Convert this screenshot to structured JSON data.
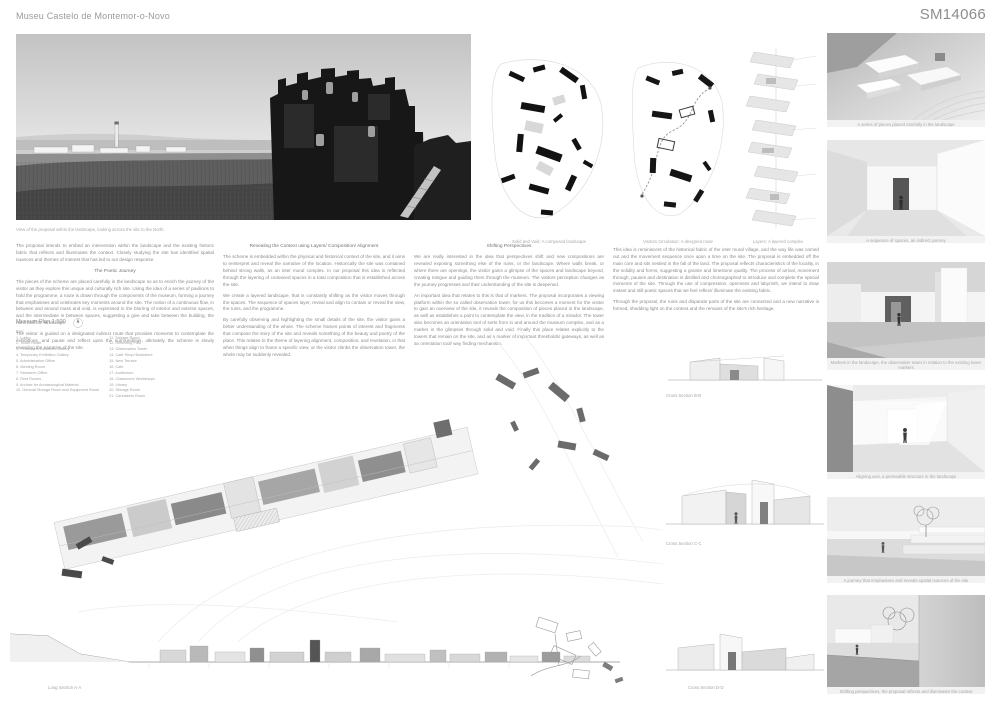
{
  "colors": {
    "paper": "#ffffff",
    "ink": "#1a1a1a",
    "muted_text": "#8b8b8b",
    "caption_gray": "#a8a8a8"
  },
  "header": {
    "title": "Museu Castelo de Montemor-o-Novo",
    "code": "SM14066"
  },
  "photo": {
    "caption": "View of the proposal within the landscape, looking across the site to the North."
  },
  "diagrams": [
    {
      "caption": "Solid and Void: A composed landscape"
    },
    {
      "caption": "Visitors Circulation: A designed route"
    },
    {
      "caption": "Layers: A layered complex"
    }
  ],
  "essays": {
    "col_a": {
      "intro": "The proposal intends to embed an intervention within the landscape and the existing historic fabric that reflects and illuminates the context. Closely studying the site has identified spatial nuances and themes of interest that has led to our design response.",
      "heading": "The Poetic Journey",
      "p1": "The pieces of the scheme are placed carefully in the landscape so as to enrich the journey of the visitor as they explore this unique and culturally rich site. Using the idea of a series of pavilions to hold the programme, a route is drawn through the components of the museum, forming a journey that emphasises and celebrates key moments around the site. The notion of a continuous flow, in between and around mass and void, is expressed in the blurring of interior and exterior spaces, and the intermediate in between spaces, suggesting a give and take between the building, the ruins and the landscape.",
      "p2": "The visitor is guided on a designated indirect route that provides moments to contemplate the exhibitions, and pause and reflect upon the surroundings, ultimately the scheme is slowly revealing the narrative of the site."
    },
    "col_b": {
      "heading": "Revealing the Context using Layers/ Composition/ Alignment",
      "p1": "The scheme is embedded within the physical and historical context of the site, and it aims to reinterpret and reveal the narrative of the location. Historically the site was contained behind strong walls, as an inter mural complex. In our proposal this idea is reflected through the layering of contained spaces in a total composition that is established across the site.",
      "p2": "We create a layered landscape, that is constantly shifting as the visitor moves through the spaces. The sequence of spaces layer, reveal and align to contain or reveal the view, the ruins, and the programme.",
      "p3": "By carefully observing and highlighting the small details of the site, the visitor gains a better understanding of the whole. The scheme frames points of interest and fragments that compose the story of the site and reveals something of the beauty and poetry of the place. This relates to the theme of layering alignment, composition, and revelation, in that when things align to frame a specific view, or the visitor climbs the observation tower, the whole may be suddenly revealed."
    },
    "col_c": {
      "heading": "Shifting Perspectives",
      "p1": "We are really interested in the idea that perspectives shift and new compositions are revealed exposing something else of the ruins, or the landscape. Where walls break, or where there are openings, the visitor gains a glimpse of the spaces and landscape beyond, creating intrigue and guiding them through the museum. The visitors perception changes as the journey progresses and their understanding of the site is deepened.",
      "p2": "An important idea that relates to this is that of markers. The proposal incorporates a viewing platform within the so called observation tower, for us this becomes a moment for the visitor to gain an overview of the site, it reveals the composition of pieces placed in the landscape, as well as establishes a point to contemplate the view, in the tradition of a mirador. The tower also becomes an orientation tool of sorts from in and around the museum complex, and as a marker in the glimpses through solid and void. Finally this place relates explicitly to the towers that remain on the site, and as a marker of important thresholds/ gateways, as well as an orientation tool/ way finding mechanism."
    },
    "col_d": {
      "p1": "This idea is reminiscent of the historical fabric of the inter mural village, and the way life was carried out and the movement sequence once upon a time on the site. The proposal is embedded off the main core and sits nestled in the fall of the land. The proposal reflects characteristics of the locality, in the solidity and forms, suggesting a granite and limestone quality. The process of arrival, movement through, pauses and destination is distilled and choreographed to introduce and complete the special moments of the site. Through the use of compression, openness and labyrinth, we intend to draw instant and still poetic spaces that we feel reflect/ illuminate the existing fabric.",
      "p2": "Through the proposal, the ruins and disparate parts of the site are connected and a new narrative is formed, shedding light on the context and the remains of the site's rich heritage."
    }
  },
  "plan": {
    "title": "Museum Plan 1:500",
    "key_label": "Key:",
    "key_left": [
      "1. Lobby",
      "2. Ticket Room",
      "3. Permanent Exhibition Gallery",
      "4. Temporary Exhibition Gallery",
      "5. Administration Office",
      "6. Meeting Room",
      "7. Research Office",
      "8. Rest Rooms",
      "9. Archive for Archaeological Material",
      "10. General Storage Room and Equipment Room"
    ],
    "key_right": [
      "11. Storage Room",
      "12. Reflecting Pool",
      "13. Observation Tower",
      "14. Cafe Shop/ Bookstore",
      "15. New Terrace",
      "16. Cafe",
      "17. Auditorium",
      "18. Classroom/ Workshops",
      "19. Library",
      "20. Storage Room",
      "21. Caretakers Room"
    ]
  },
  "sections": {
    "long_label": "Long Section A-A",
    "cross_b_label": "Cross Section B-B",
    "cross_c_label": "Cross Section C-C",
    "cross_d_label": "Cross Section D-D"
  },
  "renders": [
    {
      "caption": "A series of pieces placed carefully in the landscape"
    },
    {
      "caption": "A sequence of spaces, an indirect journey"
    },
    {
      "caption": "Markers in the landscape, the observation tower in relation to the existing tower markers"
    },
    {
      "caption": "Aligning axis, a permeable structure in the landscape"
    },
    {
      "caption": "A journey that emphasises and reveals spatial nuances of the site"
    },
    {
      "caption": "Shifting perspectives, the proposal reflects and illuminates the context"
    }
  ]
}
